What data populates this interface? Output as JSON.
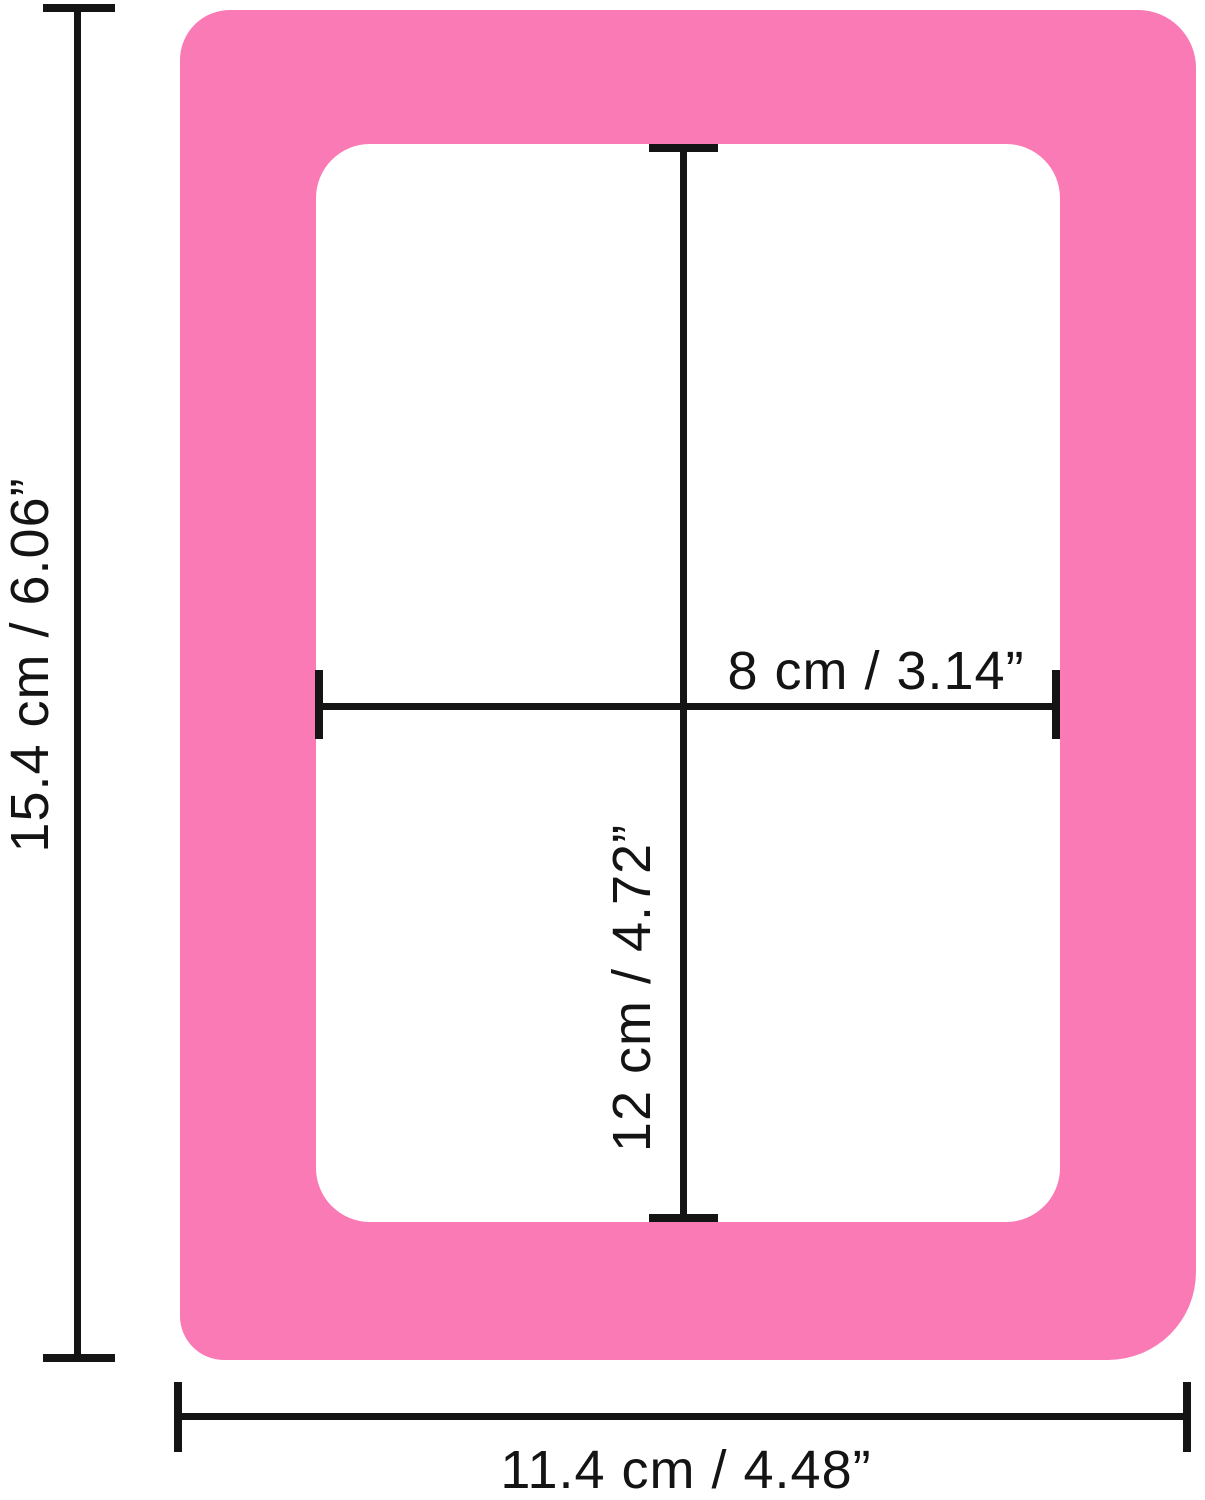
{
  "diagram": {
    "title": "photo frame dimension diagram",
    "colors": {
      "frame_pink": "#FA7AB5",
      "line_black": "#141414",
      "background": "#FFFFFF"
    },
    "dimensions": {
      "outer_height": {
        "label": "15.4 cm / 6.06”",
        "value_cm": 15.4,
        "value_in": 6.06
      },
      "outer_width": {
        "label": "11.4 cm / 4.48”",
        "value_cm": 11.4,
        "value_in": 4.48
      },
      "inner_width": {
        "label": "8 cm / 3.14”",
        "value_cm": 8,
        "value_in": 3.14
      },
      "inner_height": {
        "label": "12 cm / 4.72”",
        "value_cm": 12,
        "value_in": 4.72
      }
    }
  }
}
